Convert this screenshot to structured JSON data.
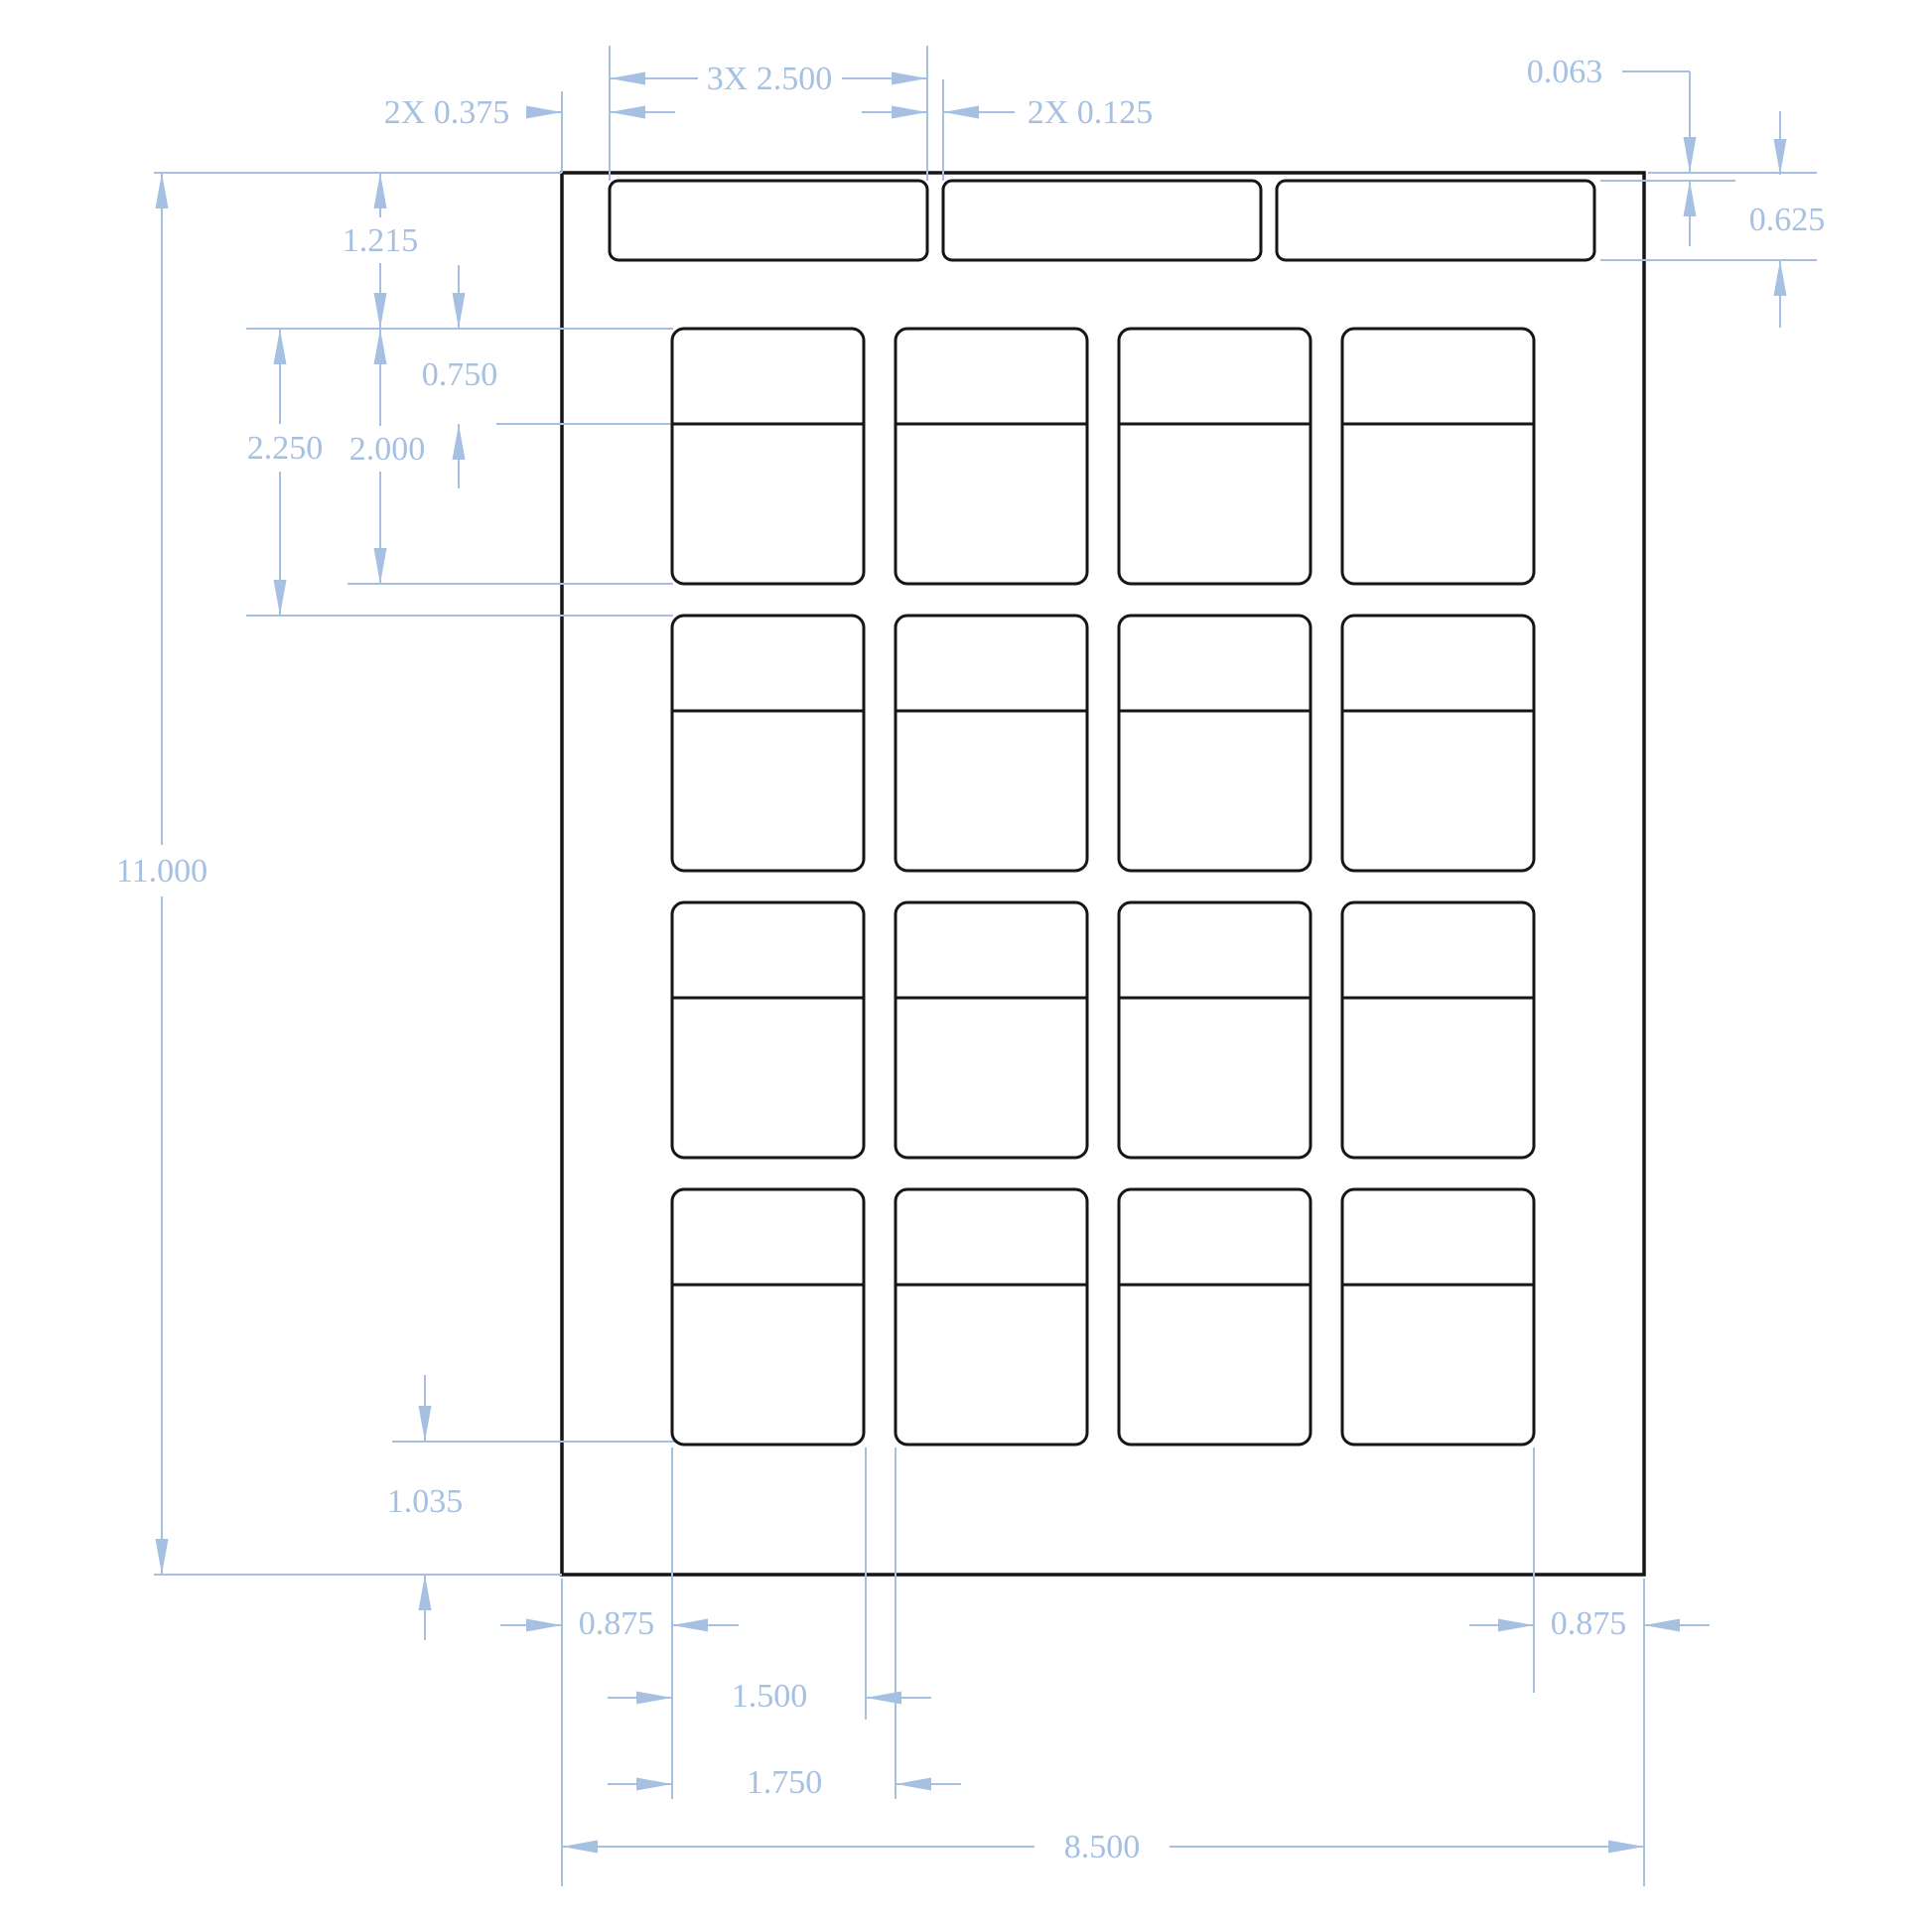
{
  "drawing": {
    "title": "Label sheet dimensioned technical drawing",
    "sheet": {
      "width_in": "8.500",
      "height_in": "11.000",
      "rows": 4,
      "columns": 4,
      "header_strips": 3
    },
    "colors": {
      "dimension_blue": "#a6c0e2",
      "hatch_blue": "#b9cde8",
      "outline_black": "#161616",
      "background": "#ffffff"
    },
    "dims": {
      "strip_width": "3X 2.500",
      "strip_side_margin": "2X 0.375",
      "strip_gap": "2X 0.125",
      "strip_top_offset": "0.063",
      "strip_height": "0.625",
      "top_margin": "1.215",
      "label_header_height": "0.750",
      "label_height": "2.000",
      "row_pitch": "2.250",
      "sheet_height": "11.000",
      "bottom_margin": "1.035",
      "left_margin": "0.875",
      "label_width": "1.500",
      "column_pitch": "1.750",
      "right_margin": "0.875",
      "sheet_width": "8.500"
    }
  }
}
